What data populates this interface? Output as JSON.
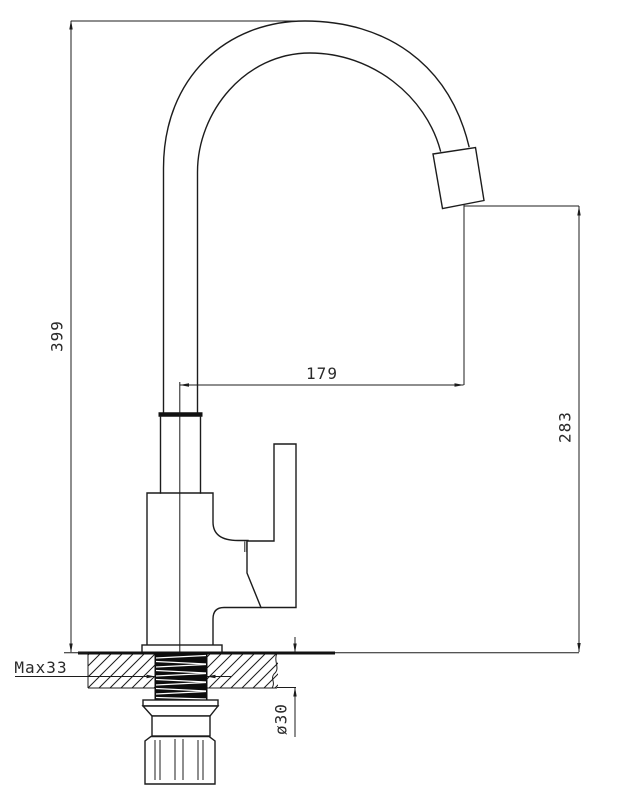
{
  "drawing_type": "faucet-installation-technical-drawing",
  "dimensions": {
    "overall_height": "399",
    "spout_reach": "179",
    "outlet_height": "283",
    "max_counter_thickness": "Max33",
    "mounting_hole_diameter": "ø30"
  },
  "colors": {
    "line": "#1c1c1c",
    "background": "#ffffff"
  }
}
